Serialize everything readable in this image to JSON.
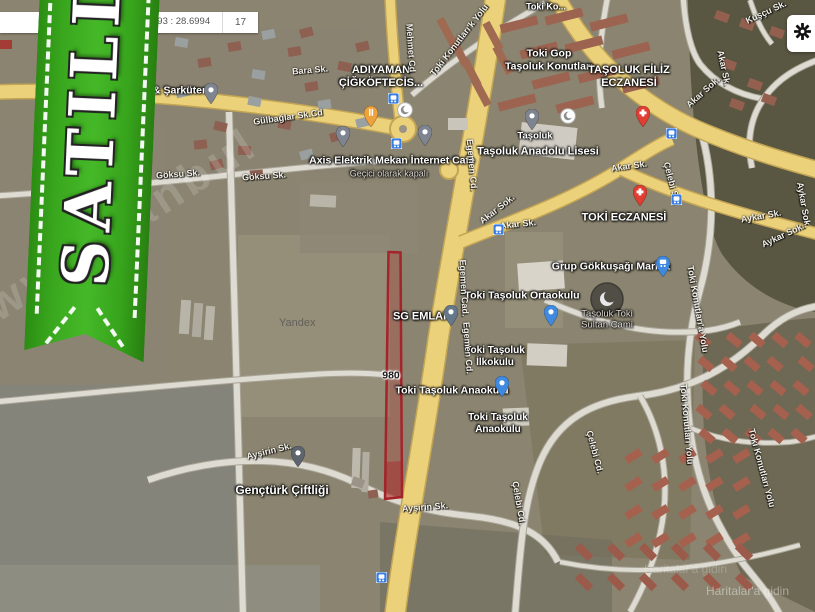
{
  "top_bar": {
    "coordinates": "093 : 28.6994",
    "zoom_level": "17"
  },
  "gear_button": {
    "icon": "gear"
  },
  "ribbon": {
    "label": "SATILDI",
    "color": "#35a41c"
  },
  "watermark": {
    "site_text": "www.istanbul",
    "provider": "Yandex",
    "attribution": "Haritalar'a gidin"
  },
  "plot_overlay": {
    "stroke": "#a3242a",
    "fill": "rgba(190,60,55,0.30)"
  },
  "map": {
    "poi_labels": [
      {
        "id": "adiyaman-cigkoftecisi",
        "lines": [
          "ADIYAMAN",
          "ÇİĞKÖFTECİS..."
        ],
        "x": 381,
        "y": 77,
        "s": 11
      },
      {
        "id": "sarkuteri",
        "lines": [
          "& Şarküteri"
        ],
        "x": 181,
        "y": 91,
        "s": 10.5
      },
      {
        "id": "axis-internet-cafe",
        "lines": [
          "Axis Elektrik Mekan İnternet Cafe"
        ],
        "x": 392,
        "y": 161,
        "s": 10.5
      },
      {
        "id": "axis-status",
        "lines": [
          "Geçici olarak kapalı"
        ],
        "x": 389,
        "y": 174,
        "s": 9,
        "variant": "muted"
      },
      {
        "id": "toki-gop-konutlari",
        "lines": [
          "Toki Gop",
          "Taşoluk Konutları"
        ],
        "x": 549,
        "y": 60,
        "s": 10.5
      },
      {
        "id": "toki-konutlari-partial",
        "lines": [
          "Toki Ko..."
        ],
        "x": 546,
        "y": 7,
        "s": 9
      },
      {
        "id": "tasoluk-filiz-eczanesi",
        "lines": [
          "TAŞOLUK FİLİZ",
          "ECZANESİ"
        ],
        "x": 629,
        "y": 77,
        "s": 11
      },
      {
        "id": "tasoluk",
        "lines": [
          "Taşoluk"
        ],
        "x": 535,
        "y": 136,
        "s": 9.5
      },
      {
        "id": "tasoluk-anadolu-lisesi",
        "lines": [
          "Taşoluk Anadolu Lisesi"
        ],
        "x": 538,
        "y": 152,
        "s": 11
      },
      {
        "id": "toki-eczanesi",
        "lines": [
          "TOKİ ECZANESİ"
        ],
        "x": 624,
        "y": 218,
        "s": 11
      },
      {
        "id": "grup-gokkusagi-market",
        "lines": [
          "Grup Gökkuşağı Market"
        ],
        "x": 611,
        "y": 267,
        "s": 10.5
      },
      {
        "id": "toki-tasoluk-ortaokulu",
        "lines": [
          "Toki Taşoluk Ortaokulu"
        ],
        "x": 522,
        "y": 296,
        "s": 10.5
      },
      {
        "id": "sg-emlak",
        "lines": [
          "SG EMLAK"
        ],
        "x": 422,
        "y": 317,
        "s": 11
      },
      {
        "id": "tasoluk-toki-sultan-cami",
        "lines": [
          "Taşoluk Toki",
          "Sultan Cami"
        ],
        "x": 607,
        "y": 320,
        "s": 9.5,
        "variant": "muted"
      },
      {
        "id": "toki-tasoluk-ilkokulu",
        "lines": [
          "Toki Taşoluk",
          "İlkokulu"
        ],
        "x": 495,
        "y": 357,
        "s": 10
      },
      {
        "id": "road-number-980",
        "lines": [
          "980"
        ],
        "x": 391,
        "y": 376,
        "s": 10.5,
        "variant": "dark"
      },
      {
        "id": "toki-tasoluk-anaokulu",
        "lines": [
          "Toki Taşoluk Anaokulu"
        ],
        "x": 452,
        "y": 391,
        "s": 10.5
      },
      {
        "id": "toki-tasoluk-anaokulu-2",
        "lines": [
          "Toki Taşoluk",
          "Anaokulu"
        ],
        "x": 498,
        "y": 424,
        "s": 10
      },
      {
        "id": "gencturk-ciftligi",
        "lines": [
          "Gençtürk Çiftliği"
        ],
        "x": 282,
        "y": 490,
        "s": 12
      }
    ],
    "street_labels": [
      {
        "text": "Göksu Sk.",
        "x": 178,
        "y": 174,
        "r": -4
      },
      {
        "text": "Göksu Sk.",
        "x": 264,
        "y": 176,
        "r": -4
      },
      {
        "text": "Bara Sk.",
        "x": 310,
        "y": 70,
        "r": -5
      },
      {
        "text": "Gülbağlar Sk.Cd",
        "x": 288,
        "y": 117,
        "r": -8
      },
      {
        "text": "Mehmet Cd",
        "x": 411,
        "y": 48,
        "r": 86
      },
      {
        "text": "Toki Konutları'k Yolu",
        "x": 459,
        "y": 40,
        "r": -52
      },
      {
        "text": "Egemen Cd.",
        "x": 472,
        "y": 165,
        "r": 85
      },
      {
        "text": "Egemen Cad.",
        "x": 464,
        "y": 288,
        "r": 87
      },
      {
        "text": "Egemen Cd.",
        "x": 468,
        "y": 348,
        "r": 86
      },
      {
        "text": "Akar Sk.",
        "x": 629,
        "y": 166,
        "r": -8
      },
      {
        "text": "Akar Sk.",
        "x": 518,
        "y": 224,
        "r": -6
      },
      {
        "text": "Akar Sok.",
        "x": 497,
        "y": 209,
        "r": -38
      },
      {
        "text": "Akar Sok.",
        "x": 703,
        "y": 92,
        "r": -42
      },
      {
        "text": "Akar Sk.",
        "x": 724,
        "y": 68,
        "r": 78
      },
      {
        "text": "Aykar Sk.",
        "x": 761,
        "y": 216,
        "r": -10
      },
      {
        "text": "Aykar Sok.",
        "x": 783,
        "y": 235,
        "r": -25
      },
      {
        "text": "Aykar Sok.",
        "x": 804,
        "y": 205,
        "r": 80
      },
      {
        "text": "Çelebi Sk.",
        "x": 672,
        "y": 183,
        "r": 75
      },
      {
        "text": "Çelebi Cd.",
        "x": 519,
        "y": 503,
        "r": 80
      },
      {
        "text": "Çelebi Cd.",
        "x": 595,
        "y": 452,
        "r": 75
      },
      {
        "text": "Ayşirin Sk.",
        "x": 269,
        "y": 451,
        "r": -14
      },
      {
        "text": "Ayşirin Sk.",
        "x": 425,
        "y": 507,
        "r": -4
      },
      {
        "text": "Toki Konutları'a Yolu",
        "x": 698,
        "y": 309,
        "r": 80
      },
      {
        "text": "Toki Konutları Yolu",
        "x": 687,
        "y": 424,
        "r": 85
      },
      {
        "text": "Toki Konutları Yolu",
        "x": 762,
        "y": 468,
        "r": 75
      },
      {
        "text": "Kuşçu Sk.",
        "x": 766,
        "y": 12,
        "r": -25
      }
    ],
    "bus_stops": [
      {
        "x": 393,
        "y": 96
      },
      {
        "x": 396,
        "y": 141
      },
      {
        "x": 671,
        "y": 131
      },
      {
        "x": 676,
        "y": 197
      },
      {
        "x": 498,
        "y": 227
      },
      {
        "x": 381,
        "y": 575
      }
    ],
    "pins": [
      {
        "type": "gray",
        "x": 211,
        "y": 104,
        "label": "sarkuteri-pin"
      },
      {
        "type": "gray",
        "x": 343,
        "y": 147,
        "label": "place-pin"
      },
      {
        "type": "orange",
        "x": 371,
        "y": 127,
        "label": "restaurant-pin"
      },
      {
        "type": "gray",
        "x": 425,
        "y": 146,
        "label": "place-pin"
      },
      {
        "type": "gray",
        "x": 532,
        "y": 130,
        "label": "tasoluk-pin"
      },
      {
        "type": "red",
        "x": 643,
        "y": 127,
        "label": "pharmacy-pin"
      },
      {
        "type": "red",
        "x": 640,
        "y": 206,
        "label": "pharmacy-pin"
      },
      {
        "type": "cart",
        "x": 663,
        "y": 277,
        "label": "market-pin"
      },
      {
        "type": "blue",
        "x": 551,
        "y": 326,
        "label": "school-pin"
      },
      {
        "type": "slate",
        "x": 451,
        "y": 326,
        "label": "sg-emlak-pin"
      },
      {
        "type": "blue",
        "x": 502,
        "y": 397,
        "label": "school-pin"
      },
      {
        "type": "darkgray",
        "x": 298,
        "y": 467,
        "label": "place-pin"
      }
    ],
    "mosques": [
      {
        "x": 405,
        "y": 110
      },
      {
        "x": 568,
        "y": 116
      }
    ]
  }
}
